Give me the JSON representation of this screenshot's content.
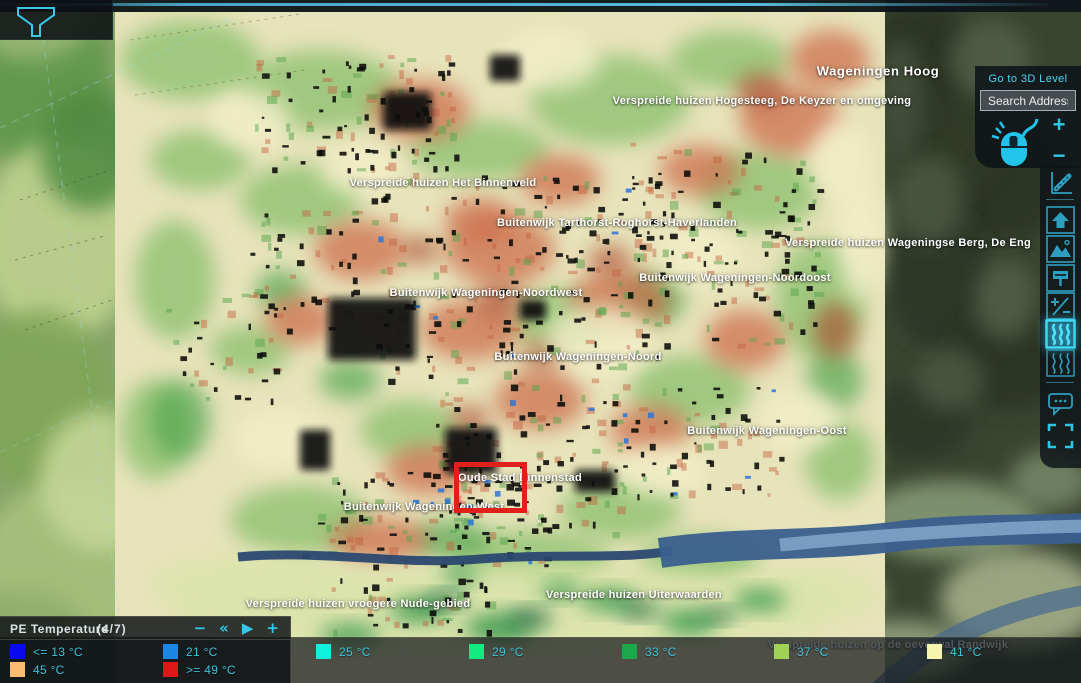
{
  "controls": {
    "go_to_3d": "Go to 3D Level",
    "search_placeholder": "Search Address",
    "zoom_in": "+",
    "zoom_out": "−"
  },
  "sidebar": {
    "tools": [
      {
        "name": "measure"
      },
      {
        "name": "home"
      },
      {
        "name": "basemap"
      },
      {
        "name": "billboard"
      },
      {
        "name": "plus-minus"
      },
      {
        "name": "heatmap",
        "active": true
      },
      {
        "name": "heatmap-alt"
      },
      {
        "name": "comments"
      },
      {
        "name": "fullscreen"
      }
    ]
  },
  "legend": {
    "title": "PE Temperature",
    "page": "(4/7)",
    "controls": [
      {
        "name": "minus",
        "glyph": "−"
      },
      {
        "name": "skip-back",
        "glyph": "«"
      },
      {
        "name": "play",
        "glyph": "▶"
      },
      {
        "name": "plus",
        "glyph": "+"
      }
    ],
    "items": [
      {
        "label": "<= 13 °C",
        "color": "#0a0af0",
        "row": 1,
        "x": 10
      },
      {
        "label": "21 °C",
        "color": "#1b86e3",
        "row": 1,
        "x": 163
      },
      {
        "label": "25 °C",
        "color": "#10f0dc",
        "row": 1,
        "x": 316
      },
      {
        "label": "29 °C",
        "color": "#10ec82",
        "row": 1,
        "x": 469
      },
      {
        "label": "33 °C",
        "color": "#1da74b",
        "row": 1,
        "x": 622
      },
      {
        "label": "37 °C",
        "color": "#a0d255",
        "row": 1,
        "x": 774
      },
      {
        "label": "41 °C",
        "color": "#f5f5b0",
        "row": 1,
        "x": 927
      },
      {
        "label": "45 °C",
        "color": "#fbbc72",
        "row": 2,
        "x": 10
      },
      {
        "label": ">= 49 °C",
        "color": "#df1616",
        "row": 2,
        "x": 163
      }
    ]
  },
  "map": {
    "labels": [
      {
        "text": "Wageningen Hoog",
        "x": 878,
        "y": 71,
        "size": "lg"
      },
      {
        "text": "Verspreide huizen Hogesteeg, De Keyzer en omgeving",
        "x": 762,
        "y": 101
      },
      {
        "text": "Verspreide huizen Het Binnenveld",
        "x": 443,
        "y": 183
      },
      {
        "text": "Buitenwijk Tarthorst-Roghorst-Haverlanden",
        "x": 617,
        "y": 223
      },
      {
        "text": "Verspreide huizen Wageningse Berg, De Eng",
        "x": 908,
        "y": 243
      },
      {
        "text": "Buitenwijk Wageningen-Noordoost",
        "x": 735,
        "y": 278
      },
      {
        "text": "Buitenwijk Wageningen-Noordwest",
        "x": 486,
        "y": 293
      },
      {
        "text": "Buitenwijk Wageningen-Noord",
        "x": 578,
        "y": 357
      },
      {
        "text": "Buitenwijk Wageningen-Oost",
        "x": 767,
        "y": 431
      },
      {
        "text": "Oude Stad Binnenstad",
        "x": 520,
        "y": 478
      },
      {
        "text": "Buitenwijk Wageningen-West",
        "x": 424,
        "y": 507
      },
      {
        "text": "Verspreide huizen Uiterwaarden",
        "x": 634,
        "y": 595
      },
      {
        "text": "Verspreide huizen vroegere Nude-gebied",
        "x": 358,
        "y": 604
      },
      {
        "text": "Verspreide huizen op de oeverwal Randwijk",
        "x": 888,
        "y": 645
      }
    ],
    "selection_box": {
      "x": 454,
      "y": 462,
      "w": 73,
      "h": 51,
      "color": "#e0201a"
    }
  },
  "colors": {
    "accent": "#2fc8ea",
    "active_tool": "#3fdcf8",
    "selection": "#e0201a"
  }
}
